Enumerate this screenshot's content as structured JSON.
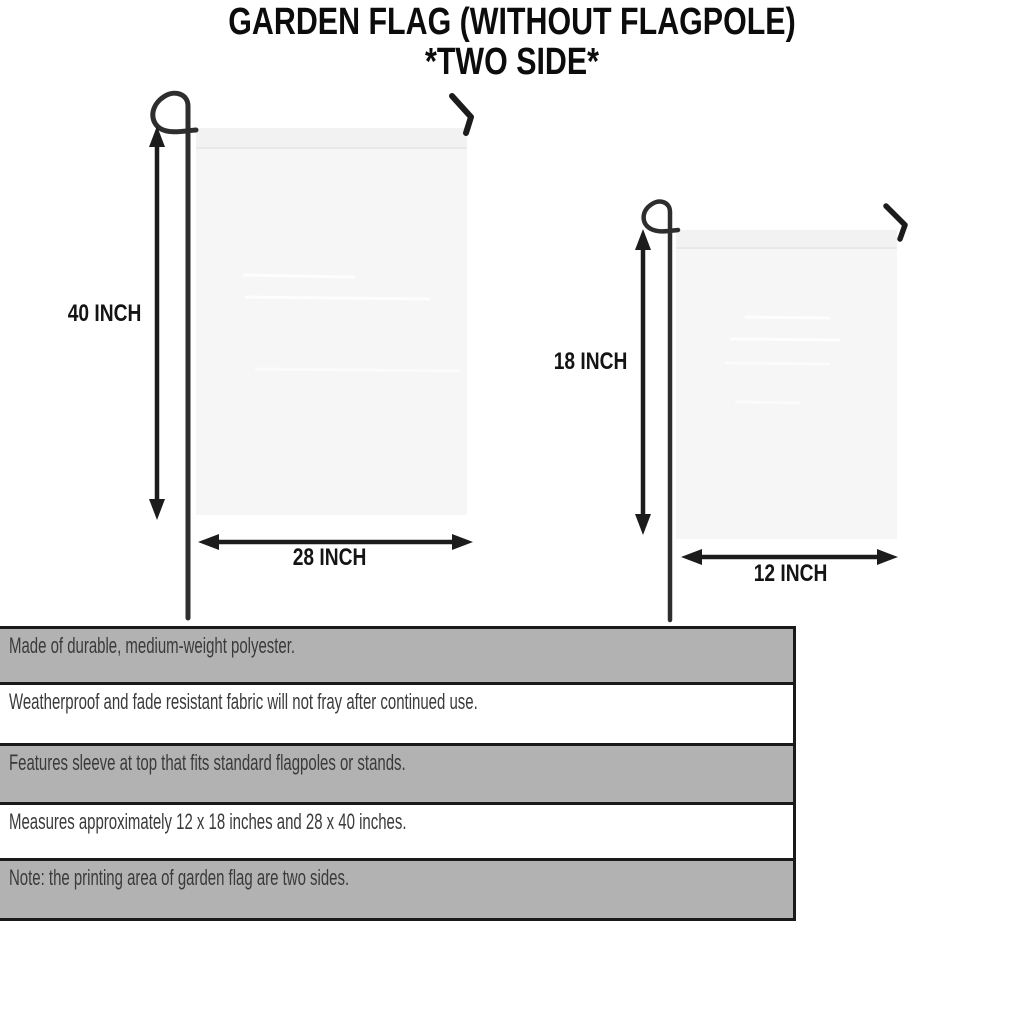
{
  "title": {
    "line1": "GARDEN FLAG (WITHOUT FLAGPOLE)",
    "line2": "*TWO SIDE*"
  },
  "diagram": {
    "large_flag": {
      "height_label": "40 INCH",
      "width_label": "28 INCH"
    },
    "small_flag": {
      "height_label": "18 INCH",
      "width_label": "12 INCH"
    }
  },
  "specs": [
    {
      "text": "Made of durable, medium-weight polyester."
    },
    {
      "text": "Weatherproof and fade resistant fabric will not fray after continued use."
    },
    {
      "text": "Features sleeve at top that fits standard flagpoles or stands."
    },
    {
      "text": "Measures approximately 12 x 18 inches and 28 x 40 inches."
    },
    {
      "text": "Note: the printing area of garden flag are two sides."
    }
  ],
  "colors": {
    "row_shaded": "#b2b2b2",
    "row_plain": "#ffffff",
    "row_border": "#1a1a1a",
    "flag_fill": "#f6f6f6",
    "line_art": "#1d1d1d",
    "pole": "#2e2e2e",
    "text": "#3a3a3a"
  }
}
